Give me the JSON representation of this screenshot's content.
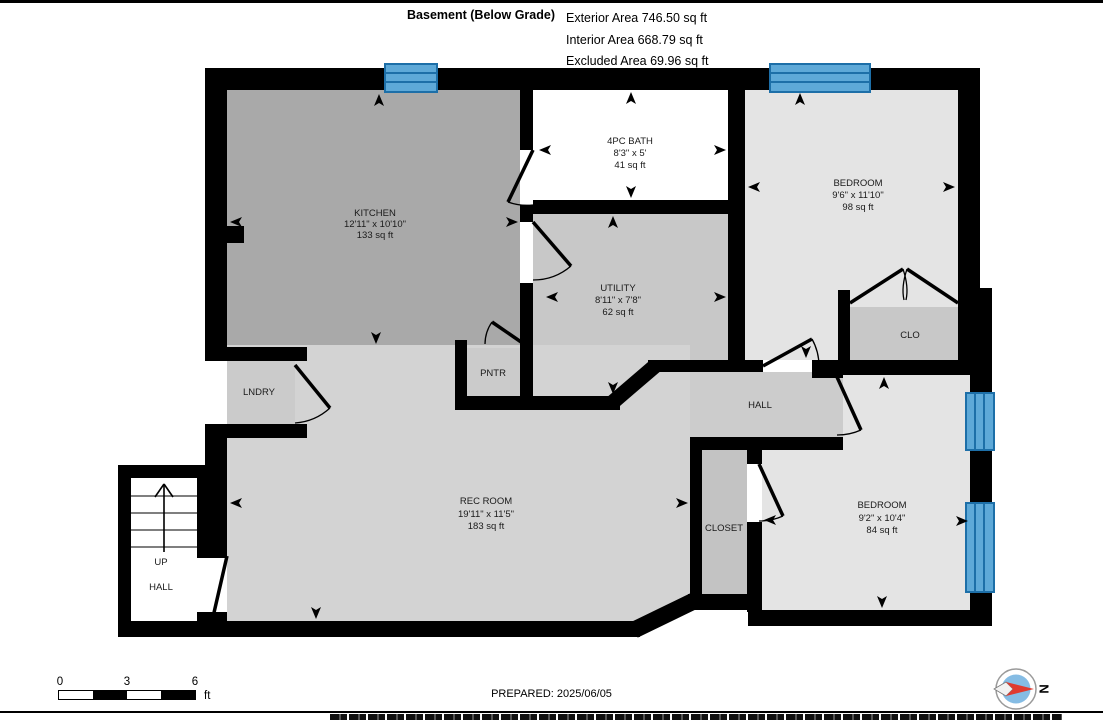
{
  "header": {
    "title": "Basement (Below Grade)",
    "area_lines": [
      "Exterior Area 746.50 sq ft",
      "Interior Area 668.79 sq ft",
      "Excluded Area 69.96 sq ft"
    ]
  },
  "rooms": {
    "kitchen": {
      "name": "KITCHEN",
      "dims": "12'11\" x 10'10\"",
      "area": "133 sq ft"
    },
    "bath": {
      "name": "4PC BATH",
      "dims": "8'3\" x 5'",
      "area": "41 sq ft"
    },
    "bedroom_top": {
      "name": "BEDROOM",
      "dims": "9'6\" x 11'10\"",
      "area": "98 sq ft"
    },
    "utility": {
      "name": "UTILITY",
      "dims": "8'11\" x 7'8\"",
      "area": "62 sq ft"
    },
    "rec_room": {
      "name": "REC ROOM",
      "dims": "19'11\" x 11'5\"",
      "area": "183 sq ft"
    },
    "bedroom_bottom": {
      "name": "BEDROOM",
      "dims": "9'2\" x 10'4\"",
      "area": "84 sq ft"
    },
    "laundry": {
      "name": "LNDRY"
    },
    "pantry": {
      "name": "PNTR"
    },
    "hall": {
      "name": "HALL"
    },
    "clo": {
      "name": "CLO"
    },
    "closet": {
      "name": "CLOSET"
    },
    "stairs": {
      "line1": "UP",
      "line2": "HALL"
    }
  },
  "footer": {
    "prepared": "PREPARED: 2025/06/05",
    "scale_ticks": [
      "0",
      "3",
      "6"
    ],
    "scale_unit": "ft",
    "compass_label": "N"
  },
  "colors": {
    "wall": "#000000",
    "window_blue": "#5ea9d8",
    "window_line_blue": "#1d6fa8",
    "compass_red": "#e03a2f",
    "compass_blue": "#85bce4"
  }
}
